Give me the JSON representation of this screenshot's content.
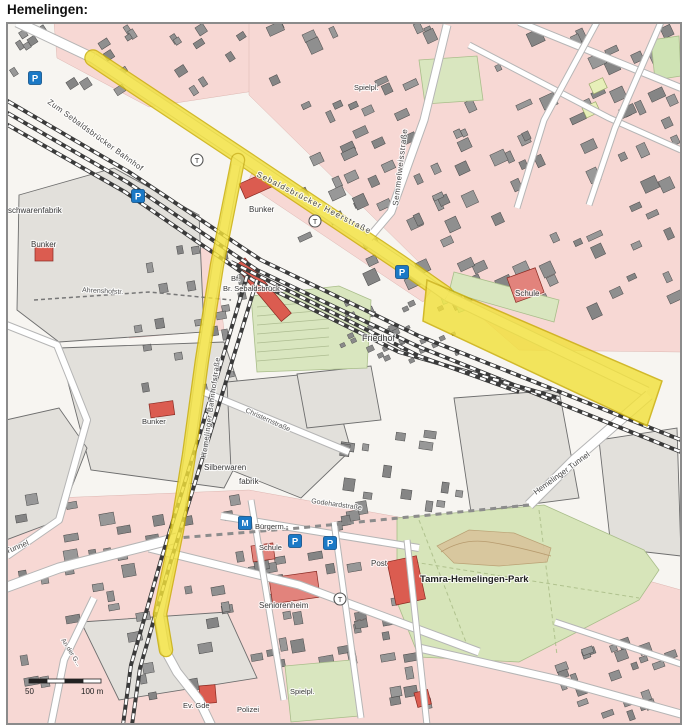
{
  "title": "Hemelingen:",
  "map": {
    "street_labels": [
      {
        "id": "street-zum-sebaldsbruecker-bahnhof",
        "text": "Zum Sebaldsbrücker Bahnhof",
        "x": 48,
        "y": 103,
        "rot": 36,
        "size": 8,
        "ls": 0.4,
        "color": "#4a4a4a"
      },
      {
        "id": "street-sebaldsbruecker-heerstrasse",
        "text": "Sebaldsbrücker Heerstraße",
        "x": 257,
        "y": 176,
        "rot": 27,
        "size": 8,
        "ls": 1.2,
        "color": "#4a4a4a"
      },
      {
        "id": "street-semmelweisstrasse",
        "text": "Semmelweisstraße",
        "x": 399,
        "y": 206,
        "rot": -83,
        "size": 8,
        "ls": 0.6,
        "color": "#4a4a4a"
      },
      {
        "id": "street-hemelinger-bahnhofstrasse",
        "text": "Hemelinger Bahnhofstraße",
        "x": 207,
        "y": 458,
        "rot": -82,
        "size": 7.5,
        "ls": 0.5,
        "color": "#4a4a4a"
      },
      {
        "id": "label-friedhof",
        "text": "Friedhof",
        "x": 363,
        "y": 341,
        "size": 9
      },
      {
        "id": "label-schule-ost",
        "text": "Schule",
        "x": 516,
        "y": 296,
        "size": 8
      },
      {
        "id": "label-bunker-1",
        "text": "Bunker",
        "x": 250,
        "y": 212,
        "size": 8
      },
      {
        "id": "label-bunker-2",
        "text": "Bunker",
        "x": 32,
        "y": 247,
        "size": 8
      },
      {
        "id": "label-bunker-3",
        "text": "Bunker",
        "x": 143,
        "y": 424,
        "size": 7.5
      },
      {
        "id": "label-bf",
        "text": "Bf.",
        "x": 232,
        "y": 281,
        "size": 7.5
      },
      {
        "id": "label-br-sebaldsbrueck",
        "text": "Br. Sebaldsbrück",
        "x": 224,
        "y": 291,
        "size": 7.5
      },
      {
        "id": "street-ahrenshofstr",
        "text": "Ahrenshofstr.",
        "x": 83,
        "y": 292,
        "rot": 3,
        "size": 7,
        "color": "#555555"
      },
      {
        "id": "label-warenfabrik",
        "text": "schwarenfabrik",
        "x": 9,
        "y": 213,
        "size": 8
      },
      {
        "id": "label-silberwaren",
        "text": "Silberwaren",
        "x": 205,
        "y": 470,
        "size": 8
      },
      {
        "id": "label-fabrik",
        "text": "fabrik",
        "x": 240,
        "y": 484,
        "size": 8
      },
      {
        "id": "street-christernstrasse",
        "text": "Christernstraße",
        "x": 246,
        "y": 412,
        "rot": 24,
        "size": 7,
        "color": "#555555"
      },
      {
        "id": "street-godehardstrasse",
        "text": "Godehardstraße",
        "x": 312,
        "y": 503,
        "rot": 8,
        "size": 7,
        "color": "#555555"
      },
      {
        "id": "label-buergerm",
        "text": "Bürgerm.-",
        "x": 256,
        "y": 529,
        "size": 7.5
      },
      {
        "id": "label-schule-sued",
        "text": "Schule",
        "x": 260,
        "y": 550,
        "size": 7.5
      },
      {
        "id": "label-post",
        "text": "Post",
        "x": 372,
        "y": 566,
        "size": 8
      },
      {
        "id": "label-tamra-park",
        "text": "Tamra-Hemelingen-Park",
        "x": 421,
        "y": 582,
        "size": 9.5,
        "bold": true,
        "color": "#222222"
      },
      {
        "id": "label-seniorenheim",
        "text": "Seniorenheim",
        "x": 260,
        "y": 608,
        "size": 8
      },
      {
        "id": "street-hemelinger-tunnel-ost",
        "text": "Hemelinger Tunnel",
        "x": 537,
        "y": 495,
        "rot": -36,
        "size": 8,
        "color": "#4a4a4a"
      },
      {
        "id": "street-hemelinger-tunnel-west",
        "text": "Hemelinger Tunnel",
        "x": -32,
        "y": 570,
        "rot": -22,
        "size": 8,
        "color": "#4a4a4a"
      },
      {
        "id": "label-spielplatz-nord",
        "text": "Spielpl.",
        "x": 355,
        "y": 90,
        "size": 7.5
      },
      {
        "id": "label-spielplatz-sued",
        "text": "Spielpl.",
        "x": 291,
        "y": 694,
        "size": 7.5
      },
      {
        "id": "label-polizei",
        "text": "Polizei",
        "x": 238,
        "y": 712,
        "size": 7.5
      },
      {
        "id": "label-ev-gde",
        "text": "Ev. Gde",
        "x": 184,
        "y": 708,
        "size": 7.5
      },
      {
        "id": "street-an-der-g",
        "text": "An der G...",
        "x": 62,
        "y": 640,
        "rot": 58,
        "size": 6.5,
        "color": "#555555"
      }
    ],
    "icons": {
      "parking_label": "P",
      "parking": [
        {
          "x": 36,
          "y": 78
        },
        {
          "x": 139,
          "y": 196
        },
        {
          "x": 403,
          "y": 272
        },
        {
          "x": 296,
          "y": 541
        },
        {
          "x": 331,
          "y": 543
        }
      ],
      "tram_label": "T",
      "tram_stops": [
        {
          "x": 198,
          "y": 160
        },
        {
          "x": 316,
          "y": 221
        },
        {
          "x": 341,
          "y": 599
        }
      ],
      "station_marker": {
        "x": 246,
        "y": 523,
        "label": "M"
      }
    },
    "scale_bar": {
      "label_left": "50",
      "label_right": "100 m"
    },
    "colors": {
      "highlight_yellow": "#f2e13c",
      "highlight_edge": "#c9ad00",
      "residential_pink": "#f7d8d4",
      "green_area": "#d9e6bf",
      "park_green": "#d7e5ba",
      "building_gray": "#8f8f8f",
      "industrial_gray": "#e2e0db",
      "red_building": "#db5c50",
      "parking_blue": "#1b79c6",
      "railway_dark": "#3a3a3a",
      "road_casing": "#b5b5b5"
    }
  }
}
